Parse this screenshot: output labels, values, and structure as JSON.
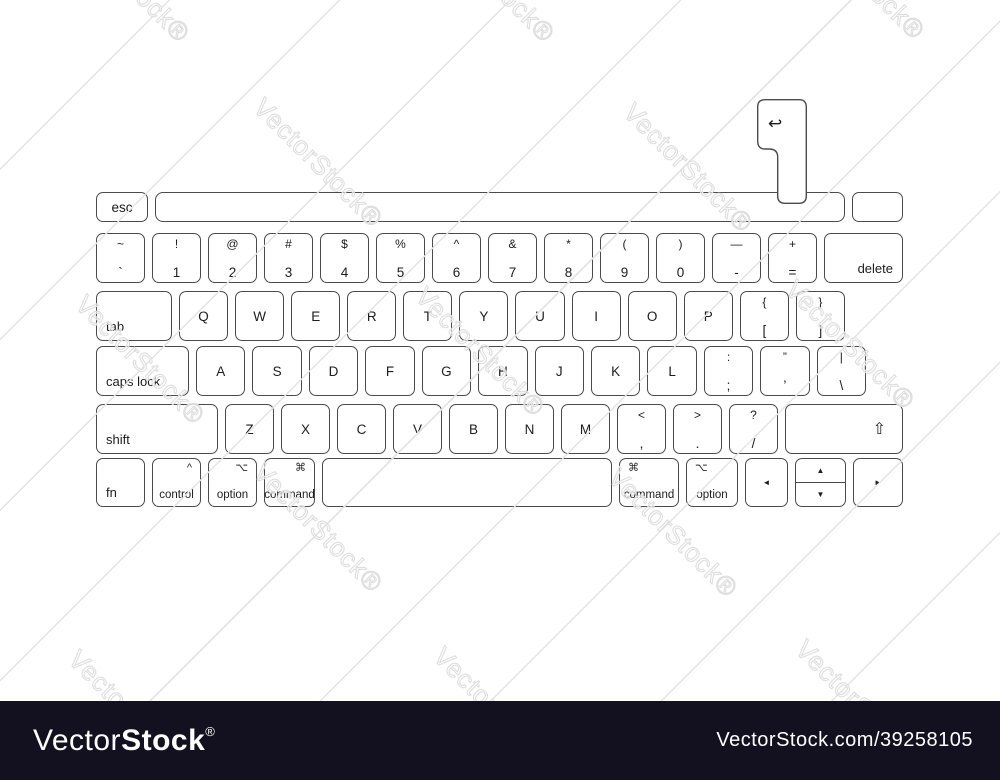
{
  "branding": {
    "watermark_text": "VectorStock®",
    "logo_light": "Vector",
    "logo_bold": "Stock",
    "logo_reg": "®",
    "footer_url": "VectorStock.com/39258105",
    "footer_bg": "#131120"
  },
  "keyboard": {
    "esc": "esc",
    "delete": "delete",
    "tab": "tab",
    "caps_lock": "caps lock",
    "caps_indicator": "•",
    "shift": "shift",
    "fn": "fn",
    "control_label": "control",
    "control_symbol": "^",
    "option_label": "option",
    "option_symbol": "⌥",
    "command_label": "command",
    "command_symbol": "⌘",
    "return_symbol": "↩",
    "shift_symbol": "⇧",
    "row_numbers": [
      {
        "top": "~",
        "bottom": "`"
      },
      {
        "top": "!",
        "bottom": "1"
      },
      {
        "top": "@",
        "bottom": "2"
      },
      {
        "top": "#",
        "bottom": "3"
      },
      {
        "top": "$",
        "bottom": "4"
      },
      {
        "top": "%",
        "bottom": "5"
      },
      {
        "top": "^",
        "bottom": "6"
      },
      {
        "top": "&",
        "bottom": "7"
      },
      {
        "top": "*",
        "bottom": "8"
      },
      {
        "top": "(",
        "bottom": "9"
      },
      {
        "top": ")",
        "bottom": "0"
      },
      {
        "top": "—",
        "bottom": "-"
      },
      {
        "top": "+",
        "bottom": "="
      }
    ],
    "row_top_letters": [
      "Q",
      "W",
      "E",
      "R",
      "T",
      "Y",
      "U",
      "I",
      "O",
      "P"
    ],
    "row_top_symbols": [
      {
        "top": "{",
        "bottom": "["
      },
      {
        "top": "}",
        "bottom": "]"
      }
    ],
    "row_home_letters": [
      "A",
      "S",
      "D",
      "F",
      "G",
      "H",
      "J",
      "K",
      "L"
    ],
    "row_home_symbols": [
      {
        "top": ":",
        "bottom": ";"
      },
      {
        "top": "”",
        "bottom": "’"
      },
      {
        "top": "|",
        "bottom": "\\"
      }
    ],
    "row_bottom_letters": [
      "Z",
      "X",
      "C",
      "V",
      "B",
      "N",
      "M"
    ],
    "row_bottom_symbols": [
      {
        "top": "<",
        "bottom": ","
      },
      {
        "top": ">",
        "bottom": "."
      },
      {
        "top": "?",
        "bottom": "/"
      }
    ],
    "arrows": {
      "left": "◄",
      "up": "▲",
      "down": "▼",
      "right": "►"
    }
  }
}
